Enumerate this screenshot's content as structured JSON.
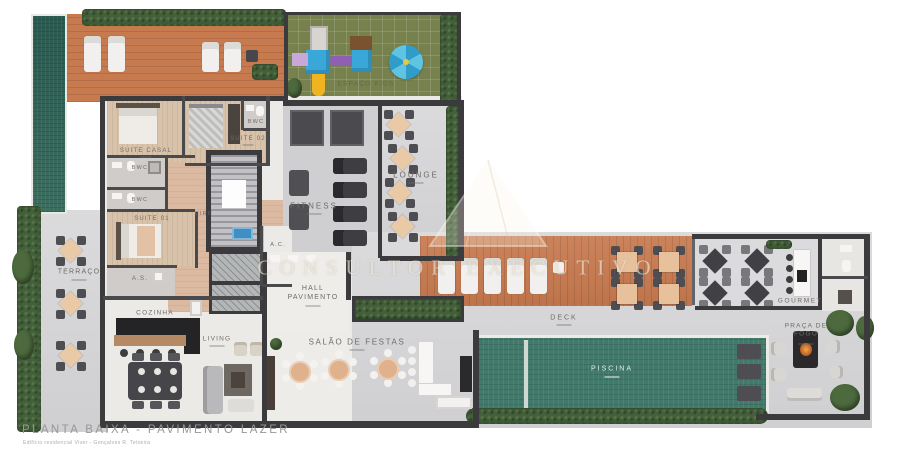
{
  "meta": {
    "title": "PLANTA BAIXA - PAVIMENTO LAZER",
    "subtitle": "Edifício residencial Viver - Gonçalves R. Teixeira"
  },
  "watermark": {
    "logo": "mountain-monogram-logo",
    "text": "CONSULTOR EXECUTIVO"
  },
  "colors": {
    "wall": "#3b3a3c",
    "wood_deck": "#c87a4f",
    "pool_water": "#41796b",
    "lap_pool": "#2b5a50",
    "kids_lawn": "#76814e",
    "hedge": "#43603a",
    "concrete": "#d6d6d8",
    "label_text": "#6f6b67",
    "table_peach": "#eac9a6",
    "play_blue": "#3aa7d9",
    "play_purple": "#8e5fb5",
    "play_yellow": "#f0b420"
  },
  "rooms": {
    "terraco": {
      "label": "TERRAÇO"
    },
    "suite_casal": {
      "label": "SUITE CASAL"
    },
    "suite_01": {
      "label": "SUITE 01"
    },
    "suite_02": {
      "label": "SUITE 02"
    },
    "bwc_suite_casal": {
      "label": "BWC"
    },
    "bwc_02": {
      "label": "BWC"
    },
    "bwc_suite_02": {
      "label": "BWC"
    },
    "circ": {
      "label": "CIRC"
    },
    "ac": {
      "label": "A.C."
    },
    "as": {
      "label": "A.S."
    },
    "cozinha": {
      "label": "COZINHA"
    },
    "living": {
      "label": "LIVING"
    },
    "fitness": {
      "label": "FITNESS"
    },
    "lounge": {
      "label": "LOUNGE"
    },
    "espaco_kids": {
      "label": "ESPAÇO KIDS"
    },
    "hall": {
      "label": "HALL PAVIMENTO"
    },
    "salao": {
      "label": "SALÃO DE FESTAS"
    },
    "deck": {
      "label": "DECK"
    },
    "piscina": {
      "label": "PISCINA"
    },
    "gourmet": {
      "label": "GOURMET"
    },
    "praca_fogo": {
      "label": "PRAÇA DE FOGO"
    }
  }
}
